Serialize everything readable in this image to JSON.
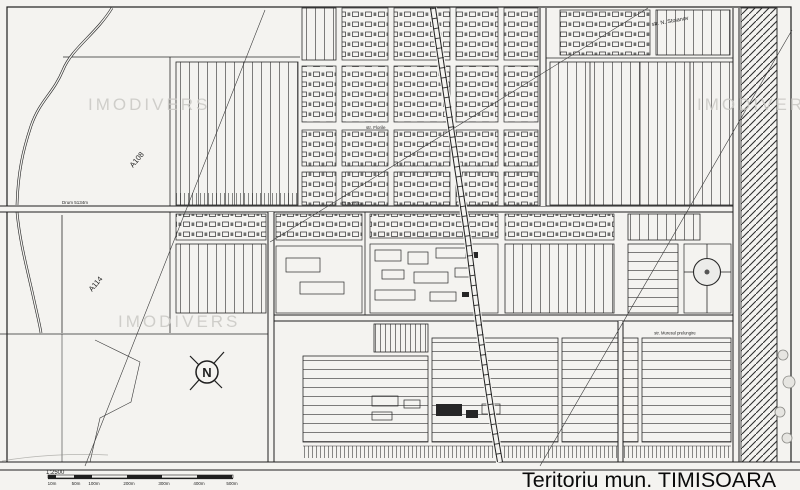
{
  "map": {
    "title": "Teritoriu mun. TIMISOARA",
    "watermark": "IMODIVERS",
    "labels": {
      "parcel_a108": "A108",
      "parcel_a114": "A114",
      "drum": "Drum 5134m",
      "str_florile": "str. Florile",
      "str_pomilor": "str. Pomilor",
      "str_muresul": "str. Muresul prelungire",
      "str_stoianov": "str. N. Stoianov",
      "compass_north": "N"
    },
    "scale": {
      "ratio": "1:2500",
      "ticks": [
        "10m",
        "50m",
        "100m",
        "200m",
        "300m",
        "400m",
        "500m"
      ]
    },
    "colors": {
      "paper": "#f4f3f0",
      "ink": "#1f1f1f",
      "watermark": "#c9c8c4"
    }
  }
}
